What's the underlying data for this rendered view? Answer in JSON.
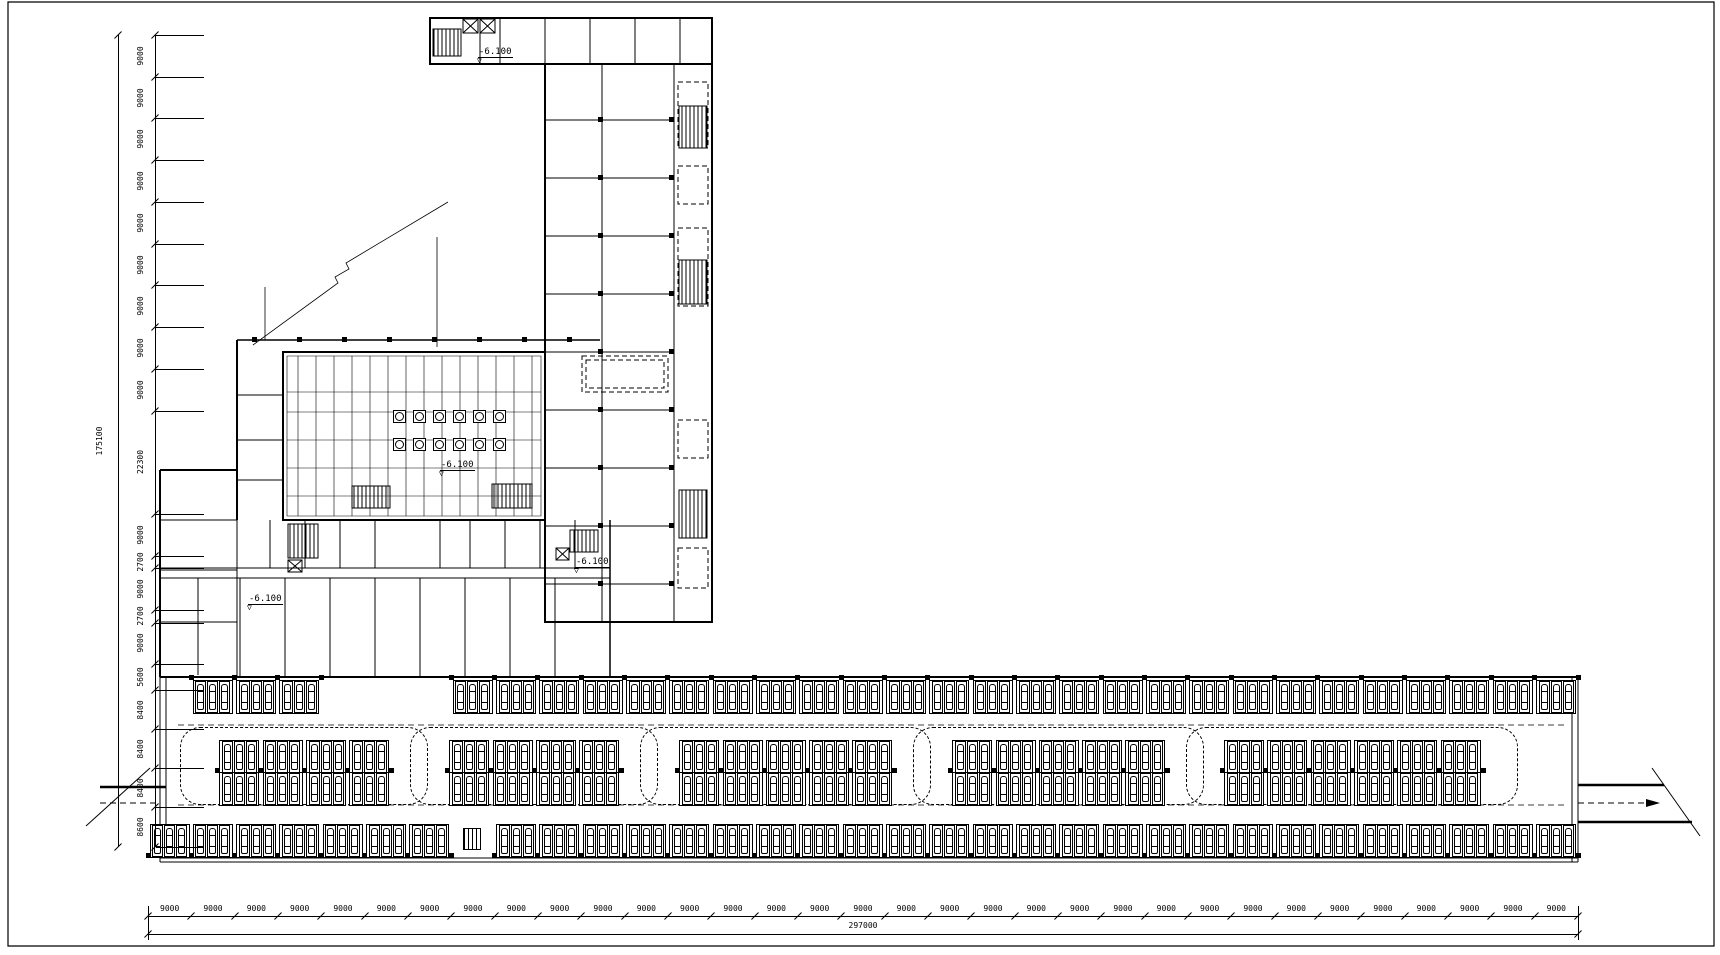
{
  "sheet": {
    "background": "#ffffff",
    "line_color": "#000000"
  },
  "levels": {
    "value": "-6.100"
  },
  "dimensions": {
    "left": {
      "total": "175100",
      "segments": [
        "9000",
        "9000",
        "9000",
        "9000",
        "9000",
        "9000",
        "9000",
        "9000",
        "9000",
        "22300",
        "9000",
        "2700",
        "9000",
        "2700",
        "9000",
        "5600",
        "8400",
        "8400",
        "8400",
        "8600"
      ]
    },
    "bottom": {
      "total": "297000",
      "count": 33,
      "segment_value": "9000"
    }
  },
  "parking": {
    "bays": 33,
    "bay_width_px": 43.333,
    "origin_x": 148,
    "top_row": {
      "y": 680,
      "skip_bays": [
        0,
        4,
        5,
        6
      ]
    },
    "bottom_row": {
      "y": 824,
      "skip_bays": [
        7
      ]
    },
    "islands": [
      {
        "x": 196,
        "w": 216
      },
      {
        "x": 426,
        "w": 216
      },
      {
        "x": 656,
        "w": 259
      },
      {
        "x": 929,
        "w": 259
      },
      {
        "x": 1202,
        "w": 300
      }
    ],
    "island_rows_y": [
      740,
      772
    ]
  }
}
